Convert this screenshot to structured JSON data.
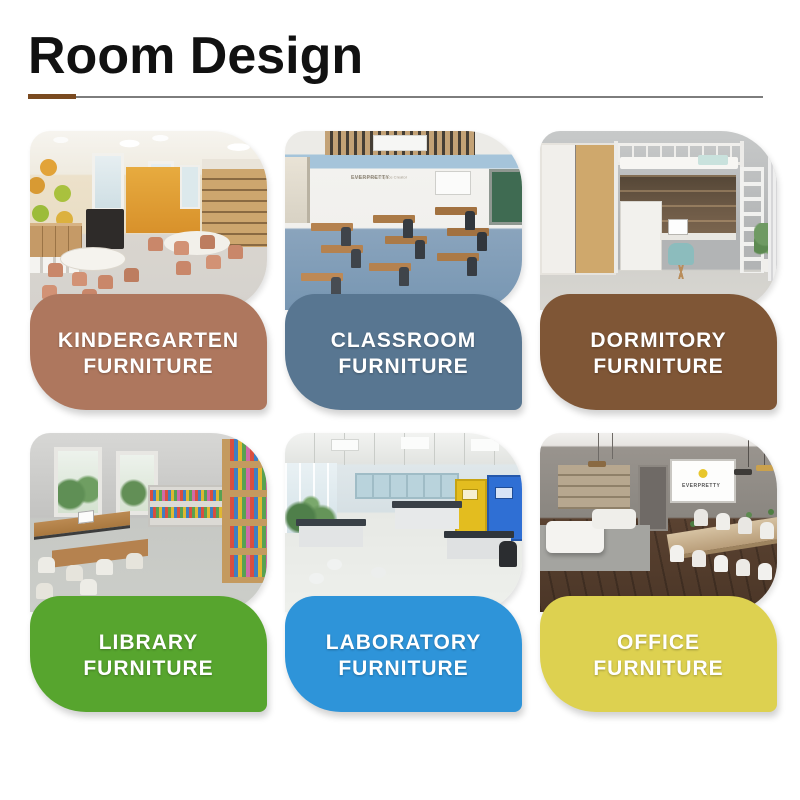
{
  "header": {
    "title": "Room Design",
    "underline_accent_color": "#7a4a20",
    "underline_line_color": "#7d7d7d"
  },
  "cards": [
    {
      "id": "kindergarten",
      "line1": "KINDERGARTEN",
      "line2": "FURNITURE",
      "panel_color": "#ae775e",
      "photo": "kindergarten room with round white tables, terracotta chairs, wooden cubbies, piano and orange accent wall"
    },
    {
      "id": "classroom",
      "line1": "CLASSROOM",
      "line2": "FURNITURE",
      "panel_color": "#587691",
      "watermark_title": "EVERPRETTY",
      "watermark_tagline": "Furniture Maker, Space Creator",
      "photo": "classroom with rows of wooden desks, dark chairs, blue floor, slatted ceiling and green board"
    },
    {
      "id": "dormitory",
      "line1": "DORMITORY",
      "line2": "FURNITURE",
      "panel_color": "#7f5636",
      "photo": "dormitory loft bed over desk with teal chair, wardrobe, white ladder and plant"
    },
    {
      "id": "library",
      "line1": "LIBRARY",
      "line2": "FURNITURE",
      "panel_color": "#57a52e",
      "photo": "library with reading tables, white chairs, windows and bookshelves full of colorful books"
    },
    {
      "id": "laboratory",
      "line1": "LABORATORY",
      "line2": "FURNITURE",
      "panel_color": "#2e94d9",
      "photo": "laboratory with white benches, stools, yellow and blue safety cabinets and windows with plants"
    },
    {
      "id": "office",
      "line1": "OFFICE",
      "line2": "FURNITURE",
      "panel_color": "#ddd150",
      "screen_text": "EVERPRETTY",
      "photo": "office meeting room with white sofas, long conference table, white chairs, projector screen and dark wood floor"
    }
  ]
}
